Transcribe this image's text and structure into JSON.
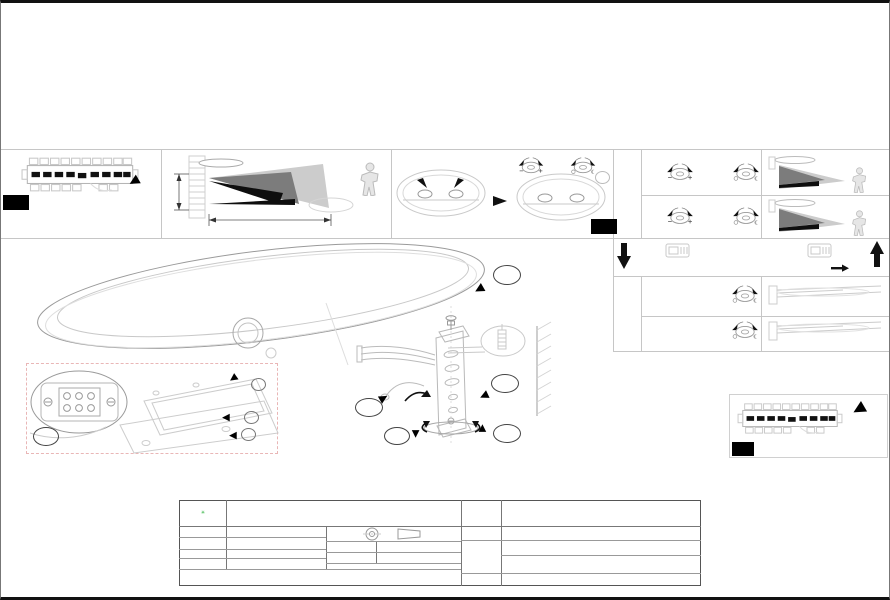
{
  "panels": {
    "a": "A",
    "b": "B",
    "c": "C"
  },
  "panel_a": {
    "state": "OFF"
  },
  "range_diagram": {
    "mount_height": "1.8-2.5m",
    "distance": "Max. 6m",
    "angle": "120°"
  },
  "panel_b": {
    "knob1_caption": "TIME",
    "knob2_caption": "LUX",
    "note": "b"
  },
  "icons": {
    "sun": "☀",
    "moon": "☾"
  },
  "mode_m1": {
    "label": "M1",
    "time_left": "10sec",
    "time_right": "8min",
    "time_caption": "TIME",
    "lux_caption": "LUX",
    "rows": [
      {
        "result": "10sec"
      },
      {
        "result": "8min"
      }
    ]
  },
  "mode_switch": {
    "press": "ON x2 <8sec",
    "release": "OFF >10sec",
    "after": "ON"
  },
  "mode_m2": {
    "label": "M2",
    "lux_caption": "LUX",
    "rows": [
      {
        "result": ""
      },
      {
        "result": "2-300lux"
      }
    ]
  },
  "branding": {
    "model": "BLA97311-1",
    "website": "www.eglo.com"
  },
  "panel_c": {
    "state": "ON"
  },
  "detail_4": {
    "number": "4",
    "terminals": {
      "n1": "N",
      "n2": "N",
      "l1": "L",
      "d": "d",
      "l2": "L"
    },
    "parts": {
      "a": "a",
      "b": "b",
      "c": "c",
      "e": "e",
      "f": "f"
    }
  },
  "assembly": {
    "s1": "1",
    "s2": "2",
    "s3": "3",
    "s5": "5",
    "s6": "6"
  },
  "print_note": "A5印刷",
  "title_block": {
    "logo_line1": "DONGJIN",
    "logo_line2": "LIGHTING",
    "company": "东莞东进照明有限公司",
    "check_label": "校对",
    "draw_label": "绘图",
    "draw_value": "张小红",
    "review_label": "审核",
    "approve_label": "批准",
    "version_label": "版次",
    "version_value": "V:1.1",
    "date_label": "日期",
    "date_value": "2018/03/16",
    "name_label": "名称",
    "name_value": "2018-048单头户外壁灯",
    "item_label": "货号",
    "item_value": "97311",
    "common_label_1": "通用",
    "common_label_2": "货号",
    "common_value": "97312",
    "approved": "approved by EGLO"
  }
}
